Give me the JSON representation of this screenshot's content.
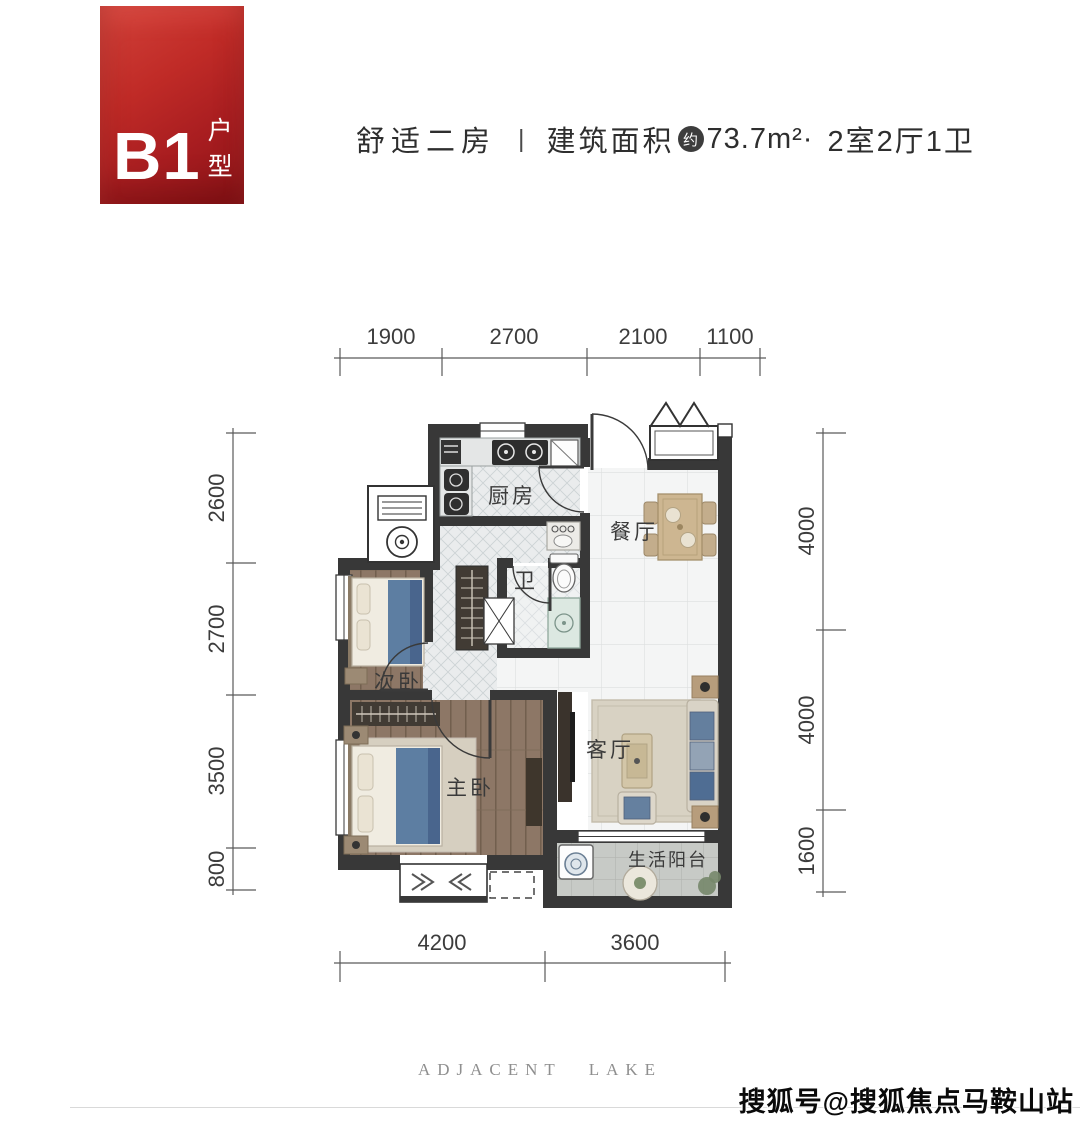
{
  "badge": {
    "code": "B1",
    "type_label": "户型"
  },
  "header": {
    "tagline": "舒适二房",
    "divider": "|",
    "area_prefix": "建筑面积",
    "area_circle": "约",
    "area_value": "73.7m²·",
    "layout_spec": "2室2厅1卫"
  },
  "floorplan": {
    "rooms": {
      "kitchen": "厨房",
      "dining": "餐厅",
      "bath": "卫",
      "bedroom2": "次卧",
      "master": "主卧",
      "living": "客厅",
      "balcony": "生活阳台"
    },
    "dimensions": {
      "top": [
        "1900",
        "2700",
        "2100",
        "1100"
      ],
      "bottom": [
        "4200",
        "3600"
      ],
      "left": [
        "2600",
        "2700",
        "3500",
        "800"
      ],
      "right": [
        "4000",
        "4000",
        "1600"
      ]
    }
  },
  "footer": {
    "brand": "ADJACENT LAKE",
    "watermark": "搜狐号@搜狐焦点马鞍山站"
  },
  "colors": {
    "badge_red": "#b5231f",
    "wall": "#383838",
    "wood_floor": "#8d7766",
    "blanket_blue": "#5d7ea2"
  }
}
